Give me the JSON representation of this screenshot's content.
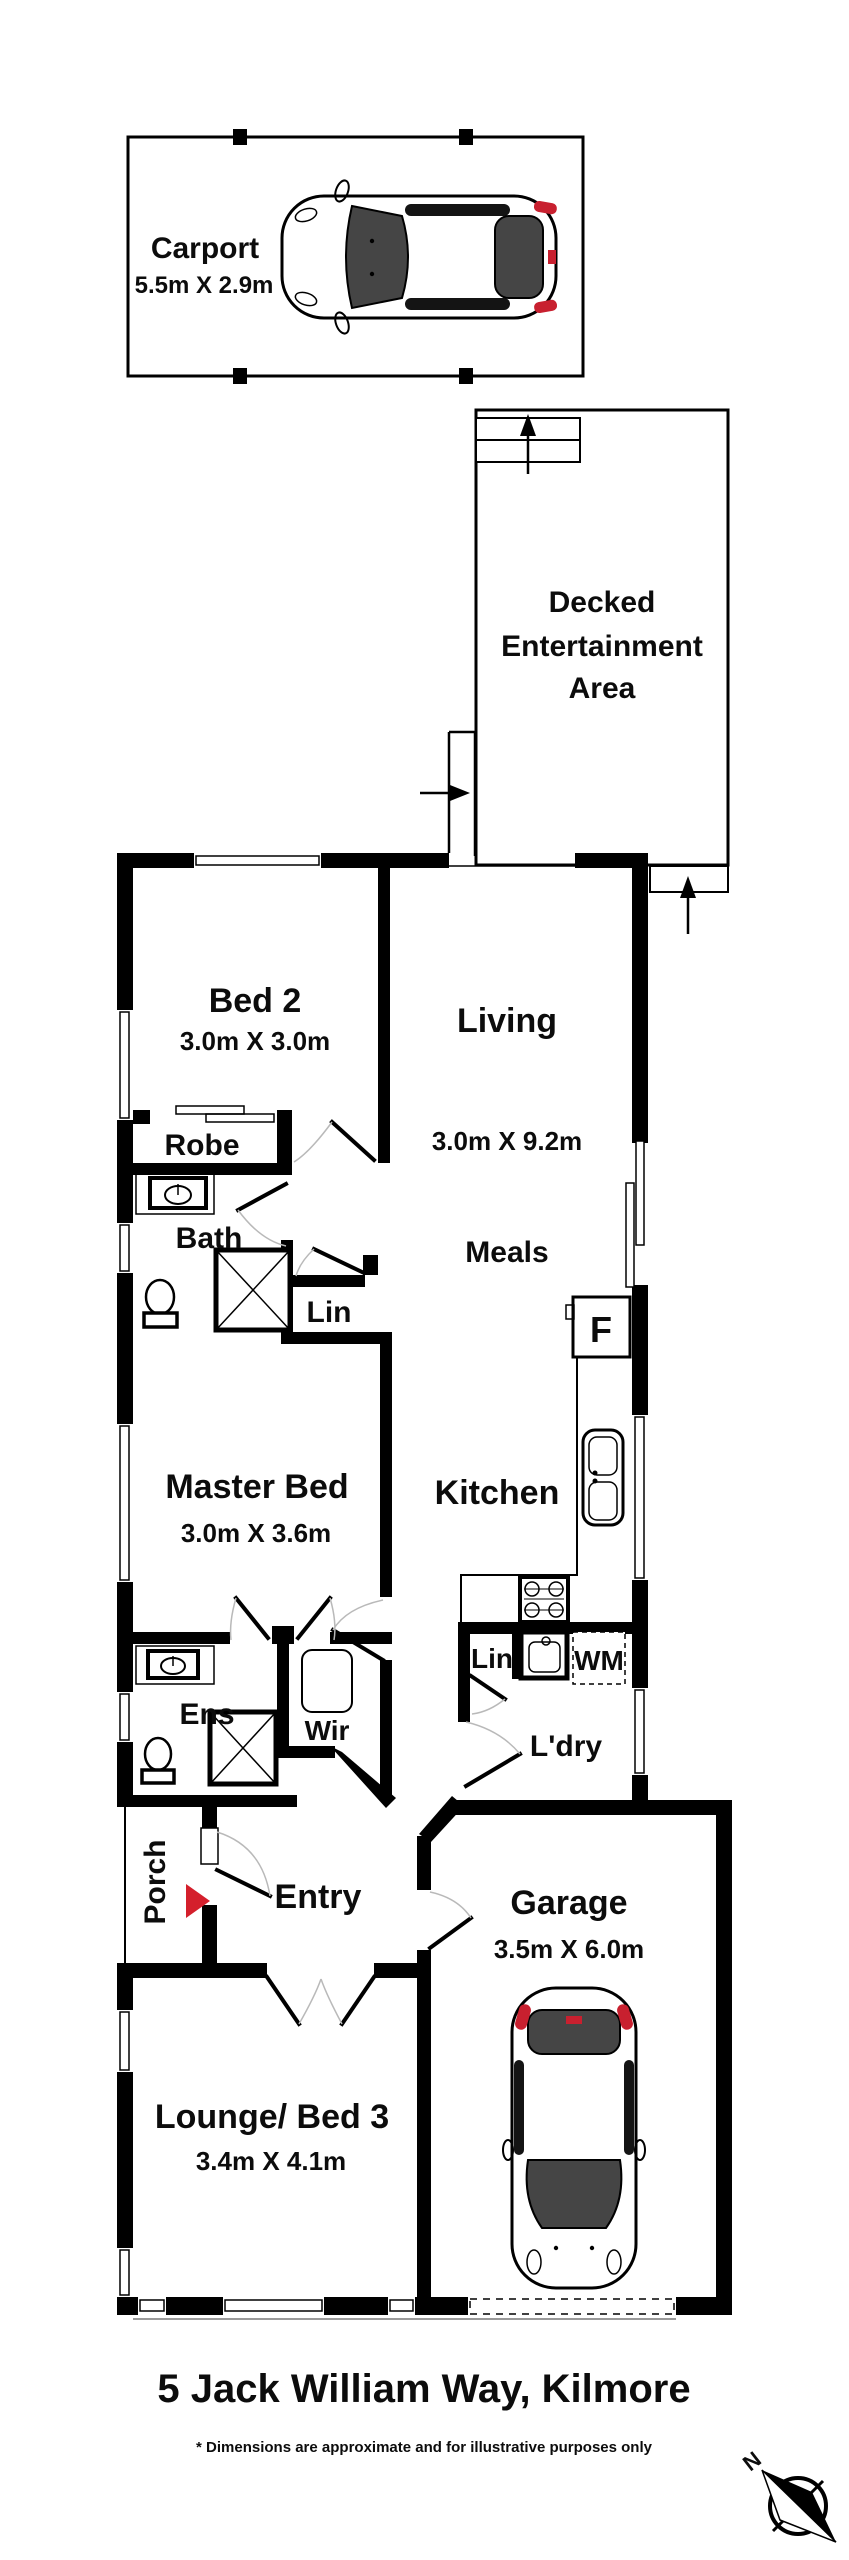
{
  "meta": {
    "address_title": "5 Jack William Way, Kilmore",
    "disclaimer": "* Dimensions are approximate and for illustrative purposes only"
  },
  "compass": {
    "north_label": "N"
  },
  "outdoor": {
    "carport": {
      "label": "Carport",
      "dims": "5.5m X 2.9m"
    },
    "deck": {
      "line1": "Decked",
      "line2": "Entertainment",
      "line3": "Area"
    },
    "porch": {
      "label": "Porch"
    }
  },
  "rooms": {
    "bed2": {
      "label": "Bed 2",
      "dims": "3.0m X 3.0m"
    },
    "living": {
      "label": "Living",
      "dims": "3.0m X 9.2m"
    },
    "meals": {
      "label": "Meals"
    },
    "kitchen": {
      "label": "Kitchen"
    },
    "master": {
      "label": "Master Bed",
      "dims": "3.0m X 3.6m"
    },
    "bath": {
      "label": "Bath"
    },
    "robe": {
      "label": "Robe"
    },
    "lin_hall": {
      "label": "Lin"
    },
    "ens": {
      "label": "Ens"
    },
    "wir": {
      "label": "Wir"
    },
    "laundry": {
      "label": "L'dry"
    },
    "lin_laundry": {
      "label": "Lin"
    },
    "entry": {
      "label": "Entry"
    },
    "garage": {
      "label": "Garage",
      "dims": "3.5m X 6.0m"
    },
    "lounge": {
      "label": "Lounge/ Bed 3",
      "dims": "3.4m X 4.1m"
    }
  },
  "appliances": {
    "fridge": "F",
    "washing_machine": "WM"
  },
  "colors": {
    "wall": "#000000",
    "accent_red": "#d41f2c"
  }
}
